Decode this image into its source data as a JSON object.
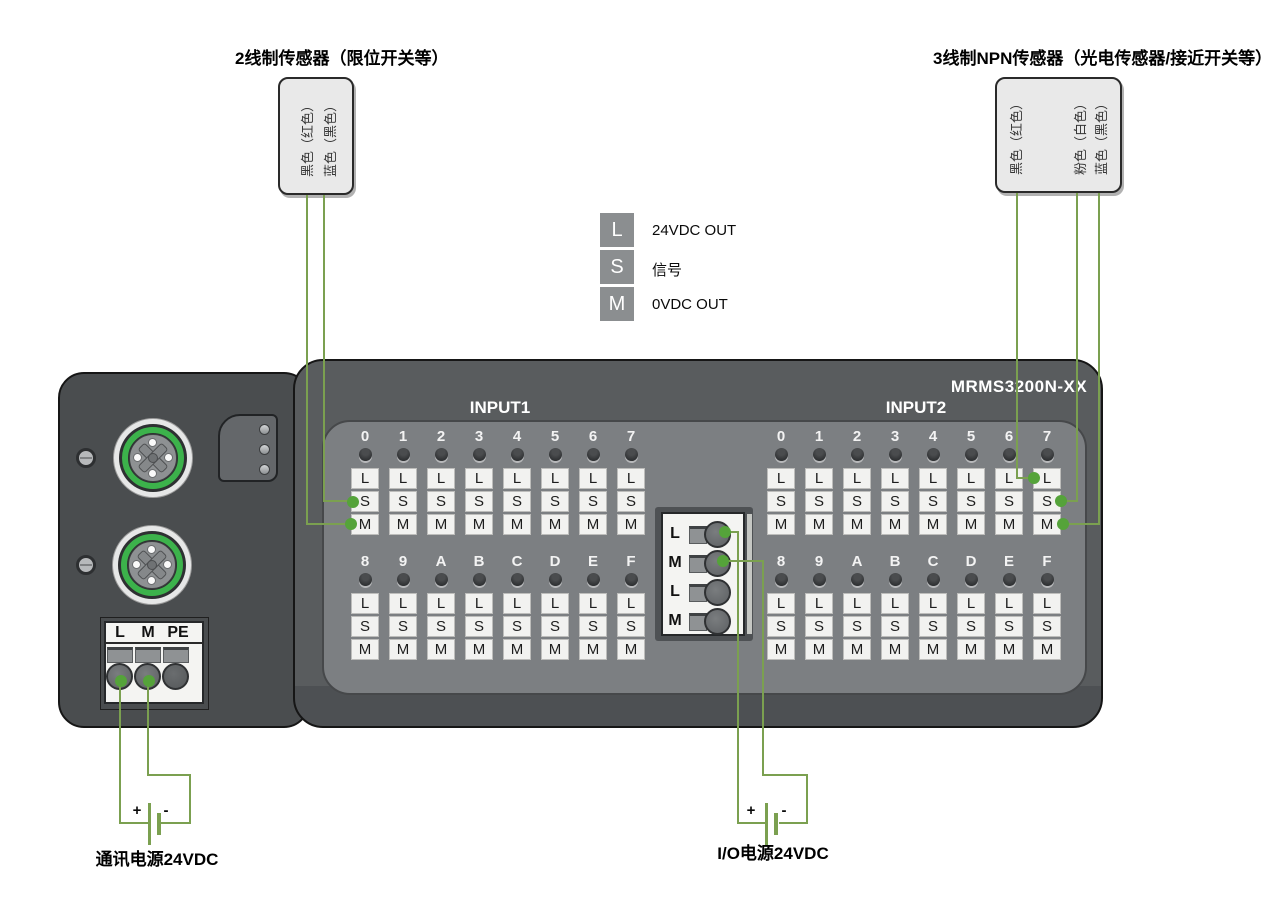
{
  "sensor2": {
    "title": "2线制传感器（限位开关等）",
    "wires": [
      "黑色（红色）",
      "蓝色（黑色）"
    ]
  },
  "sensor3": {
    "title": "3线制NPN传感器（光电传感器/接近开关等）",
    "wires": [
      "黑色（红色）",
      "粉色（白色）",
      "蓝色（黑色）"
    ]
  },
  "legend": {
    "items": [
      {
        "key": "L",
        "label": "24VDC OUT"
      },
      {
        "key": "S",
        "label": "信号"
      },
      {
        "key": "M",
        "label": "0VDC OUT"
      }
    ]
  },
  "device": {
    "model": "MRMS3200N-XX",
    "terminal_letters": [
      "L",
      "S",
      "M"
    ],
    "inputs": [
      {
        "name": "INPUT1",
        "rows": [
          [
            "0",
            "1",
            "2",
            "3",
            "4",
            "5",
            "6",
            "7"
          ],
          [
            "8",
            "9",
            "A",
            "B",
            "C",
            "D",
            "E",
            "F"
          ]
        ]
      },
      {
        "name": "INPUT2",
        "rows": [
          [
            "0",
            "1",
            "2",
            "3",
            "4",
            "5",
            "6",
            "7"
          ],
          [
            "8",
            "9",
            "A",
            "B",
            "C",
            "D",
            "E",
            "F"
          ]
        ]
      }
    ],
    "power_terminal_labels": [
      "L",
      "M",
      "PE"
    ],
    "io_terminal_labels": [
      "L",
      "M",
      "L",
      "M"
    ]
  },
  "power": {
    "comm": {
      "label": "通讯电源24VDC",
      "plus": "+",
      "minus": "-"
    },
    "io": {
      "label": "I/O电源24VDC",
      "plus": "+",
      "minus": "-"
    }
  },
  "colors": {
    "wire": "#7ba050",
    "dot": "#55a33a",
    "connector_ring": "#3cb24b",
    "device_body": "#595c5e",
    "device_left": "#4a4d4f",
    "panel": "#7c7f82"
  }
}
